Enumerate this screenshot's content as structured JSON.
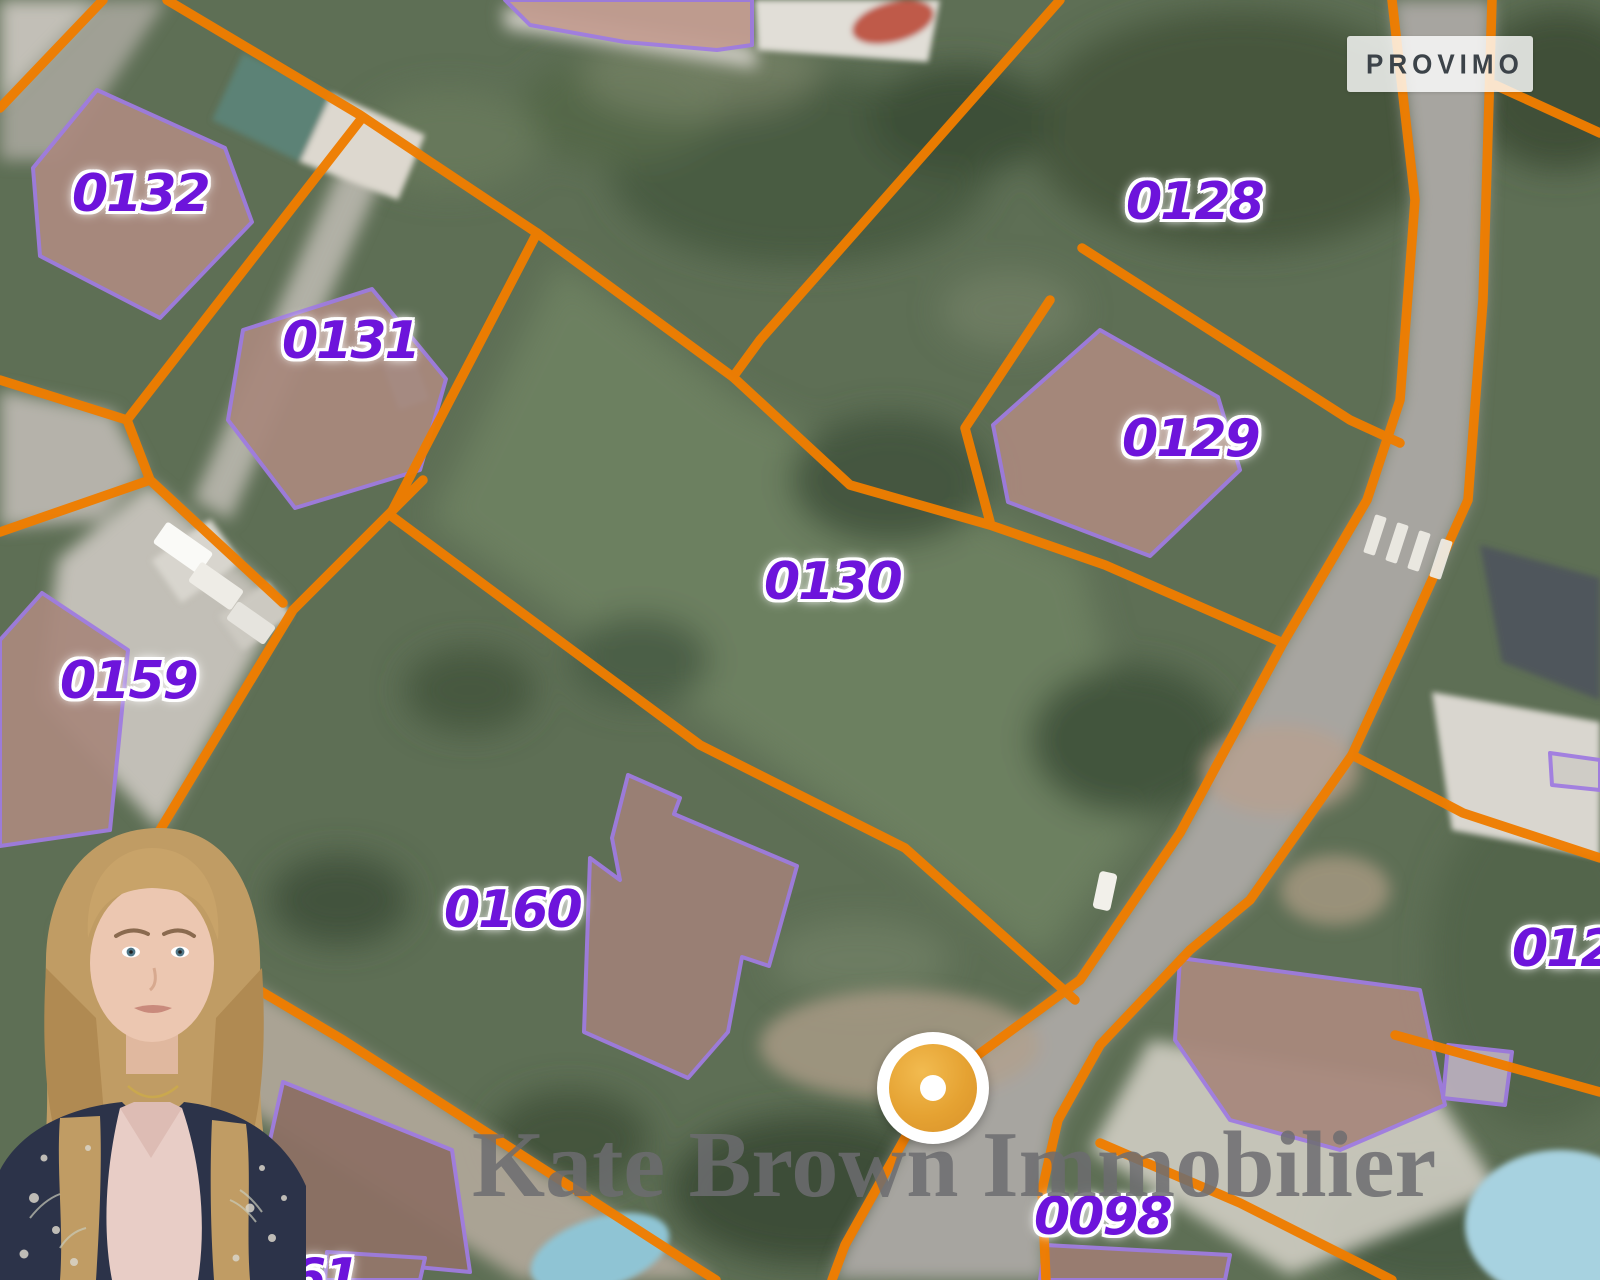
{
  "map": {
    "brand": {
      "name": "PROVIMO",
      "icon": "house-p-icon"
    },
    "watermark_text": "Kate Brown Immobilier",
    "marker": {
      "type": "location-pin"
    },
    "parcel_labels": [
      {
        "id": "0132",
        "text": "0132"
      },
      {
        "id": "0131",
        "text": "0131"
      },
      {
        "id": "0128",
        "text": "0128"
      },
      {
        "id": "0129",
        "text": "0129"
      },
      {
        "id": "0130",
        "text": "0130"
      },
      {
        "id": "0159",
        "text": "0159"
      },
      {
        "id": "0160",
        "text": "0160"
      },
      {
        "id": "0098",
        "text": "0098"
      },
      {
        "id": "012-partial",
        "text": "012"
      },
      {
        "id": "61-partial",
        "text": "61"
      }
    ],
    "colors": {
      "parcel_line_orange": "#ef7d00",
      "building_outline_purple": "#a07ce0",
      "label_purple": "#6d14db",
      "marker_amber": "#e5a232",
      "watermark_gray": "#6d6d70"
    }
  }
}
